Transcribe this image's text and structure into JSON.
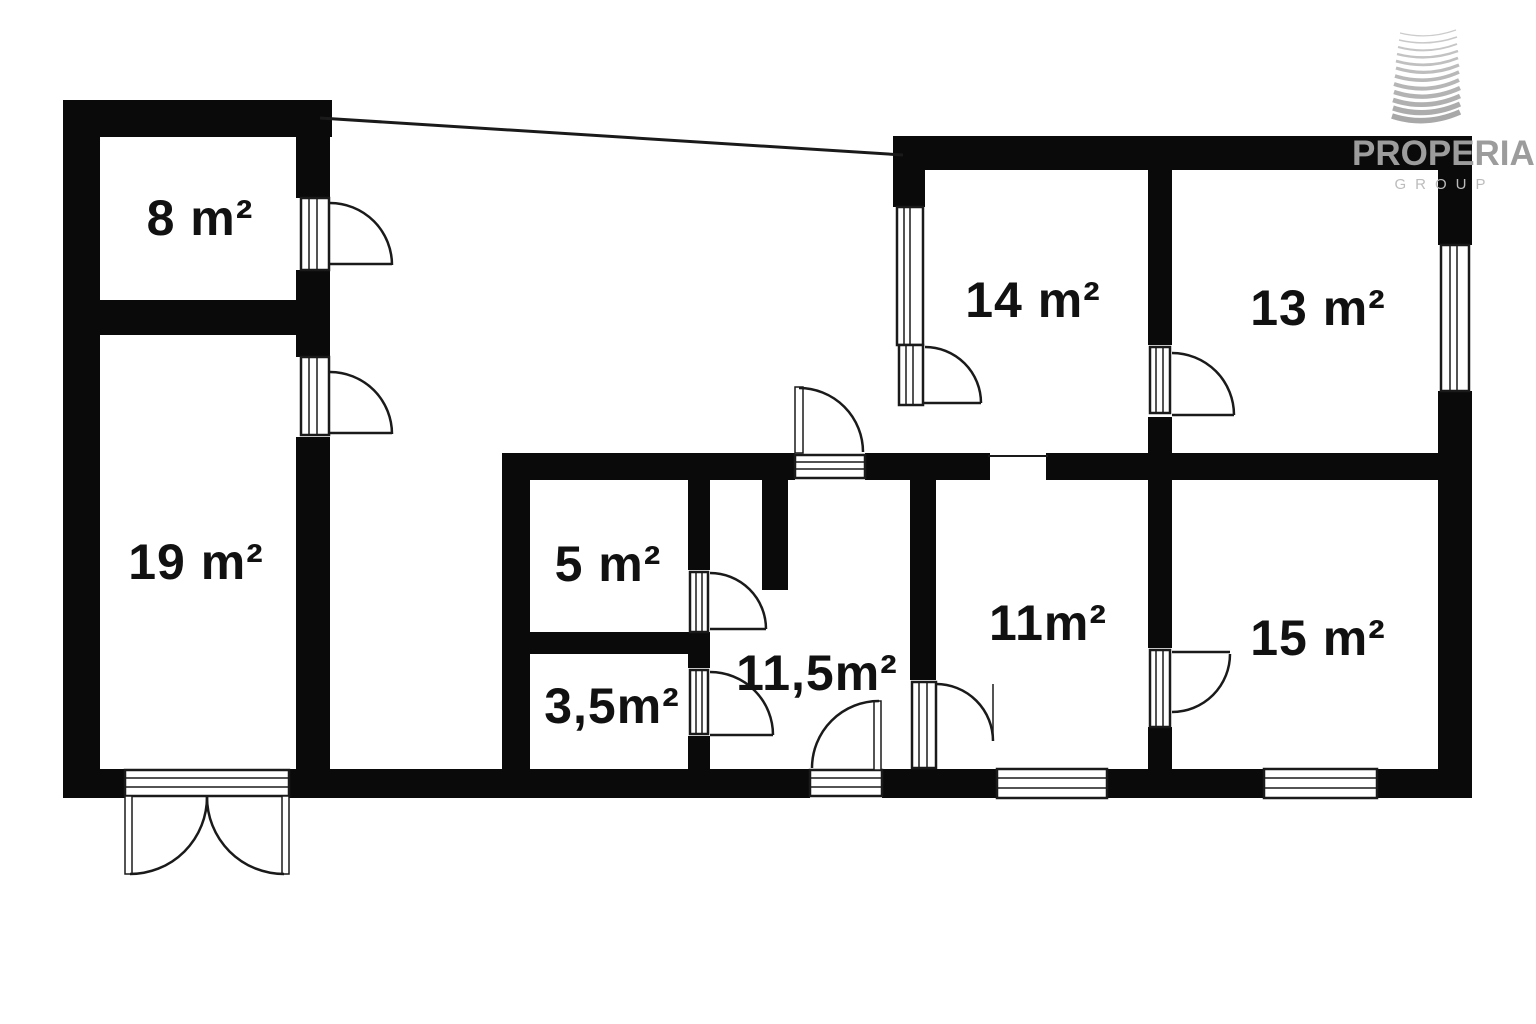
{
  "rooms": [
    {
      "name": "room-8",
      "area_label": "8 m²"
    },
    {
      "name": "room-19",
      "area_label": "19 m²"
    },
    {
      "name": "room-14",
      "area_label": "14 m²"
    },
    {
      "name": "room-13",
      "area_label": "13 m²"
    },
    {
      "name": "room-5",
      "area_label": "5 m²"
    },
    {
      "name": "room-3-5",
      "area_label": "3,5m²"
    },
    {
      "name": "room-11-5",
      "area_label": "11,5m²"
    },
    {
      "name": "room-11",
      "area_label": "11m²"
    },
    {
      "name": "room-15",
      "area_label": "15 m²"
    }
  ],
  "logo": {
    "brand": "PROPERIA",
    "subtitle": "GROUP"
  },
  "colors": {
    "background": "#ffffff",
    "wall": "#0a0a0a",
    "symbol_line": "#1a1a1a",
    "label_text": "#111111",
    "logo_text": "#9c9c9c",
    "logo_subtitle": "#bcbcbc",
    "logo_wave_light": "#c9c9c9",
    "logo_wave_dark": "#a8a8a8"
  }
}
